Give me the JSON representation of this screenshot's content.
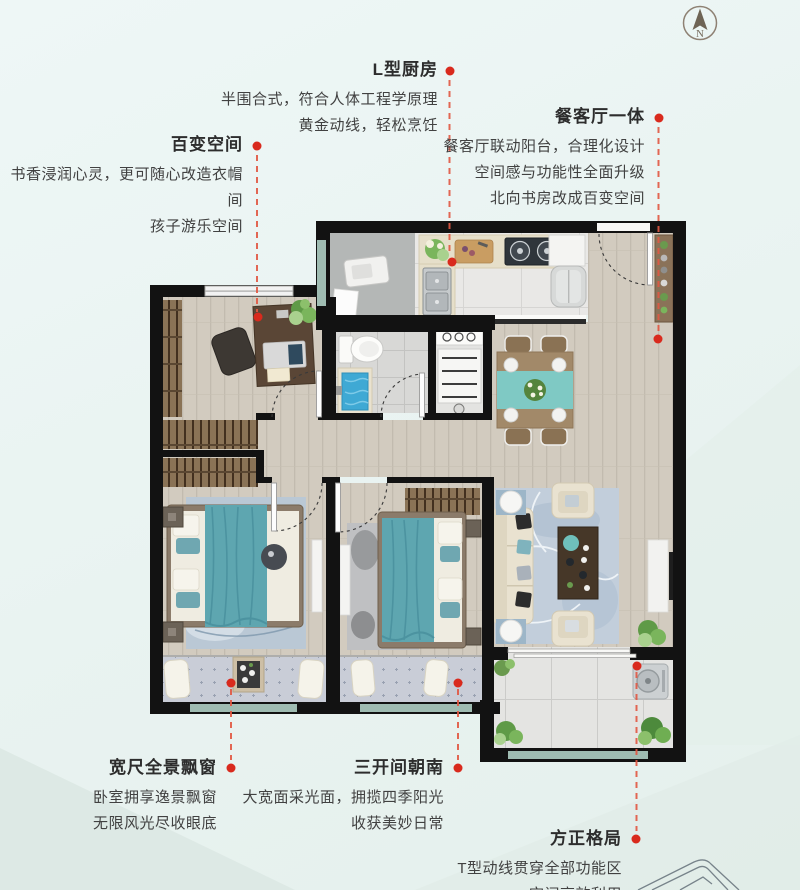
{
  "compass": {
    "label": "N"
  },
  "callouts": [
    {
      "id": "kitchen",
      "title": "L型厨房",
      "lines": [
        "半围合式，符合人体工程学原理",
        "黄金动线，轻松烹饪"
      ]
    },
    {
      "id": "flex-space",
      "title": "百变空间",
      "lines": [
        "书香浸润心灵，更可随心改造衣帽间",
        "孩子游乐空间"
      ]
    },
    {
      "id": "dining-living",
      "title": "餐客厅一体",
      "lines": [
        "餐客厅联动阳台，合理化设计",
        "空间感与功能性全面升级",
        "北向书房改成百变空间"
      ]
    },
    {
      "id": "bay-window",
      "title": "宽尺全景飘窗",
      "lines": [
        "卧室拥享逸景飘窗",
        "无限风光尽收眼底"
      ]
    },
    {
      "id": "south-rooms",
      "title": "三开间朝南",
      "lines": [
        "大宽面采光面，拥揽四季阳光",
        "收获美妙日常"
      ]
    },
    {
      "id": "square-layout",
      "title": "方正格局",
      "lines": [
        "T型动线贯穿全部功能区",
        "空间高效利用"
      ]
    }
  ],
  "theme": {
    "accent_red": "#d92a1d",
    "leader_red": "#e25742",
    "wall_black": "#121212",
    "wood_floor": "#d2cbbf",
    "sill_teal": "#9fbcb2",
    "bay_cushion": "#c9cdd7",
    "teal_furniture": "#5ea6b0",
    "bg_mint": "#e9f3f1",
    "text_dark": "#414141"
  }
}
